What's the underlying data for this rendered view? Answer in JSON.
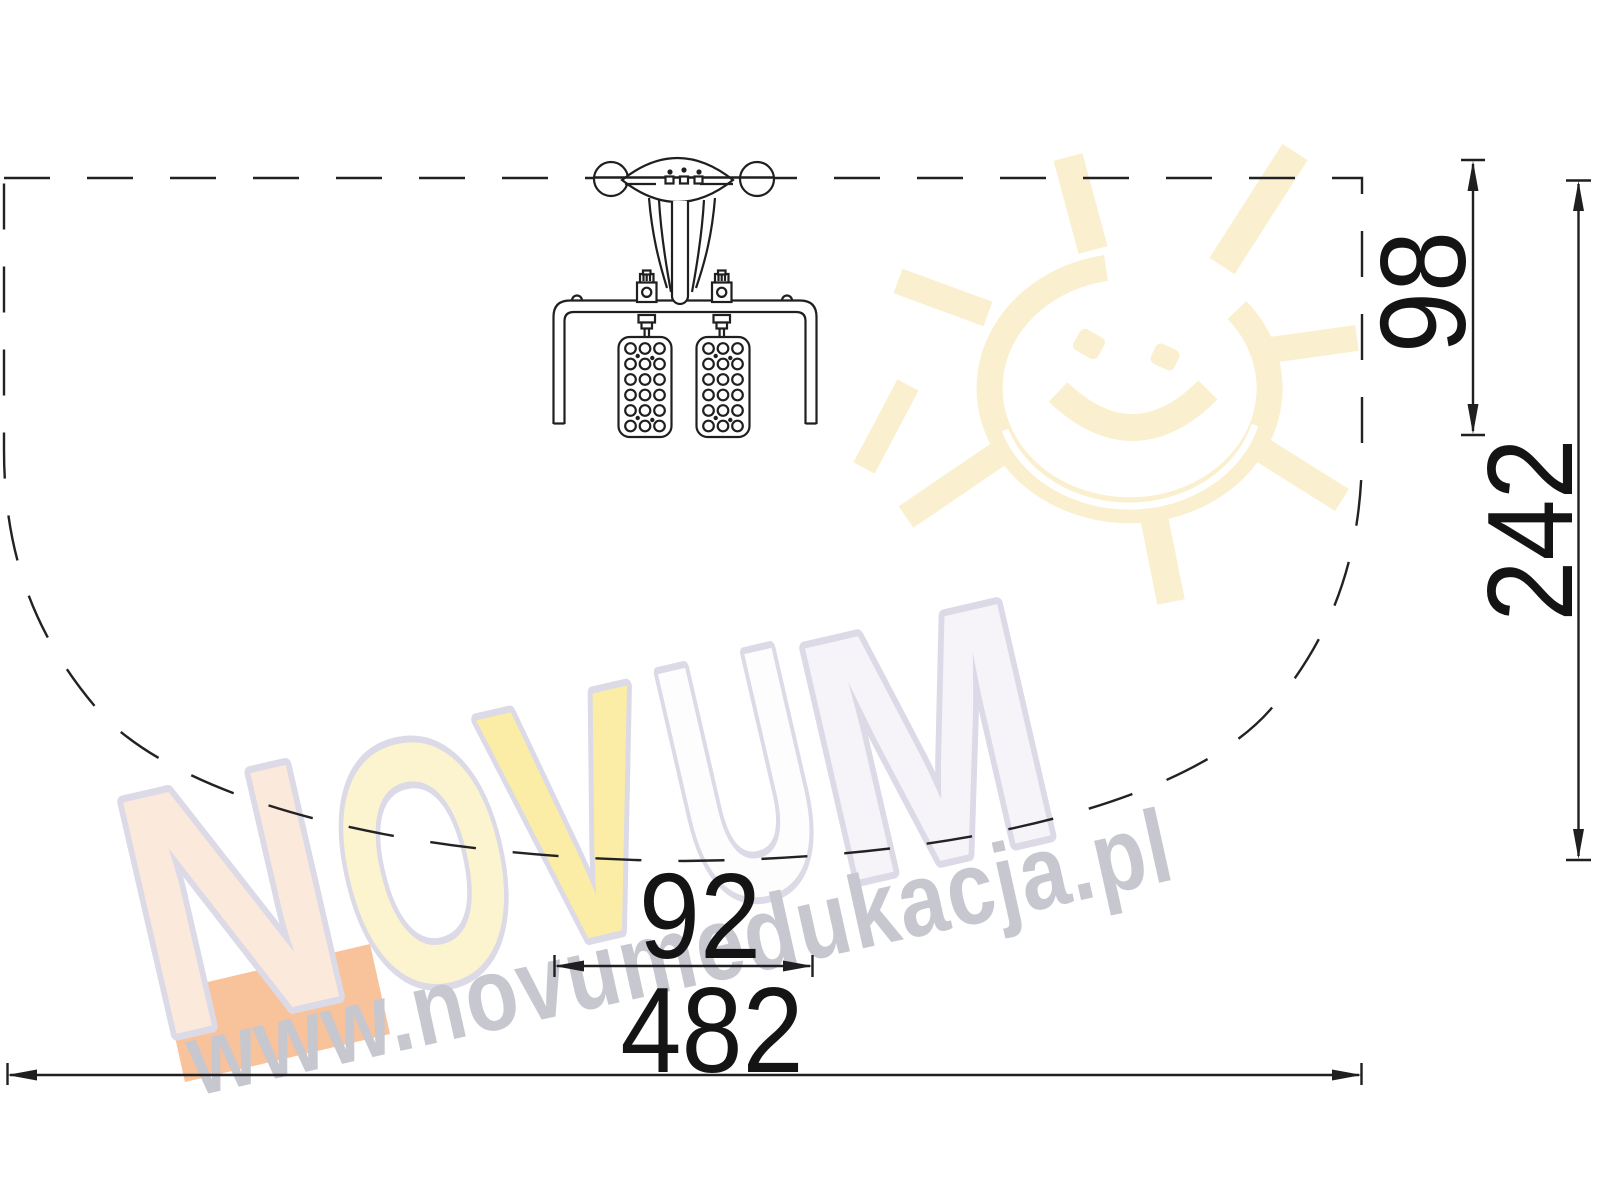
{
  "dimensions": {
    "device_depth": "98",
    "safety_zone_depth": "242",
    "device_width": "92",
    "safety_zone_width": "482"
  },
  "watermark": {
    "logo": {
      "letters": [
        "N",
        "O",
        "V",
        "U",
        "M"
      ]
    },
    "url": "www.novumedukacja.pl"
  },
  "colors": {
    "line": "#1f1f1f",
    "dim_text": "#141414",
    "zone_dash": "#222222",
    "sun": "#faf0d0",
    "url_text": "#c7c7d0",
    "letter_outline": "#dbdae6",
    "letter_n": "#fbe9dc",
    "letter_o": "#fcf4cf",
    "letter_v": "#fbeda6",
    "letter_u": "#fdfdfe",
    "letter_m": "#f6f4f9",
    "accent_block": "#f8c29a"
  }
}
